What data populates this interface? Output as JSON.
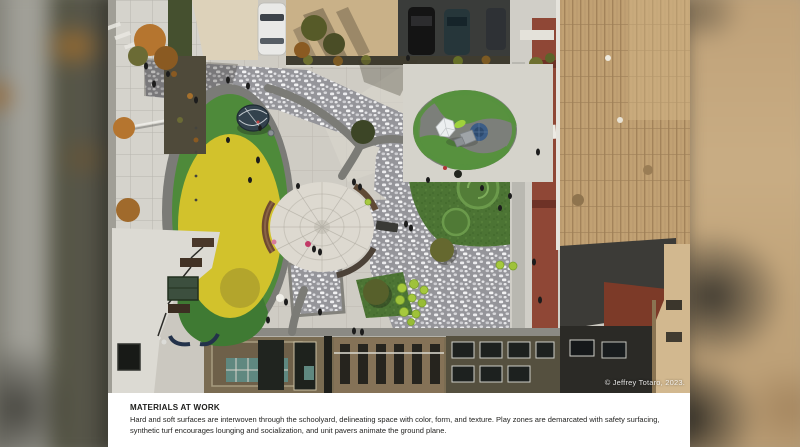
{
  "slide": {
    "caption": {
      "title": "MATERIALS AT WORK",
      "body": "Hard and soft surfaces are interwoven through the schoolyard, delineating space with color, form, and texture. Play zones are demarcated with safety surfacing, synthetic turf encourages lounging and socialization, and unit pavers animate the ground plane."
    },
    "photo": {
      "credit": "© Jeffrey Totaro, 2023.",
      "description": "Aerial drone view of an urban schoolyard courtyard: circular concrete plaza ringed by curved wood benches, a yellow-and-green rubber safety-surfacing play oval with a climbing dome, a striped green-and-gray play circle with geodesic climbers, synthetic turf mounds, speckled unit-paver walkways, lime sphere seats, fall street trees, parked cars, and surrounding building rooftops",
      "palette": {
        "safety_surface_yellow": "#d2c22c",
        "rubber_green": "#4e8a3a",
        "turf_green": "#4c7434",
        "paver_gray": "#95959a",
        "concrete_light": "#cbc8c0",
        "roof_tan": "#c1a173",
        "bench_brown": "#6f4a31",
        "asphalt_dark": "#3a3c3a"
      }
    }
  }
}
